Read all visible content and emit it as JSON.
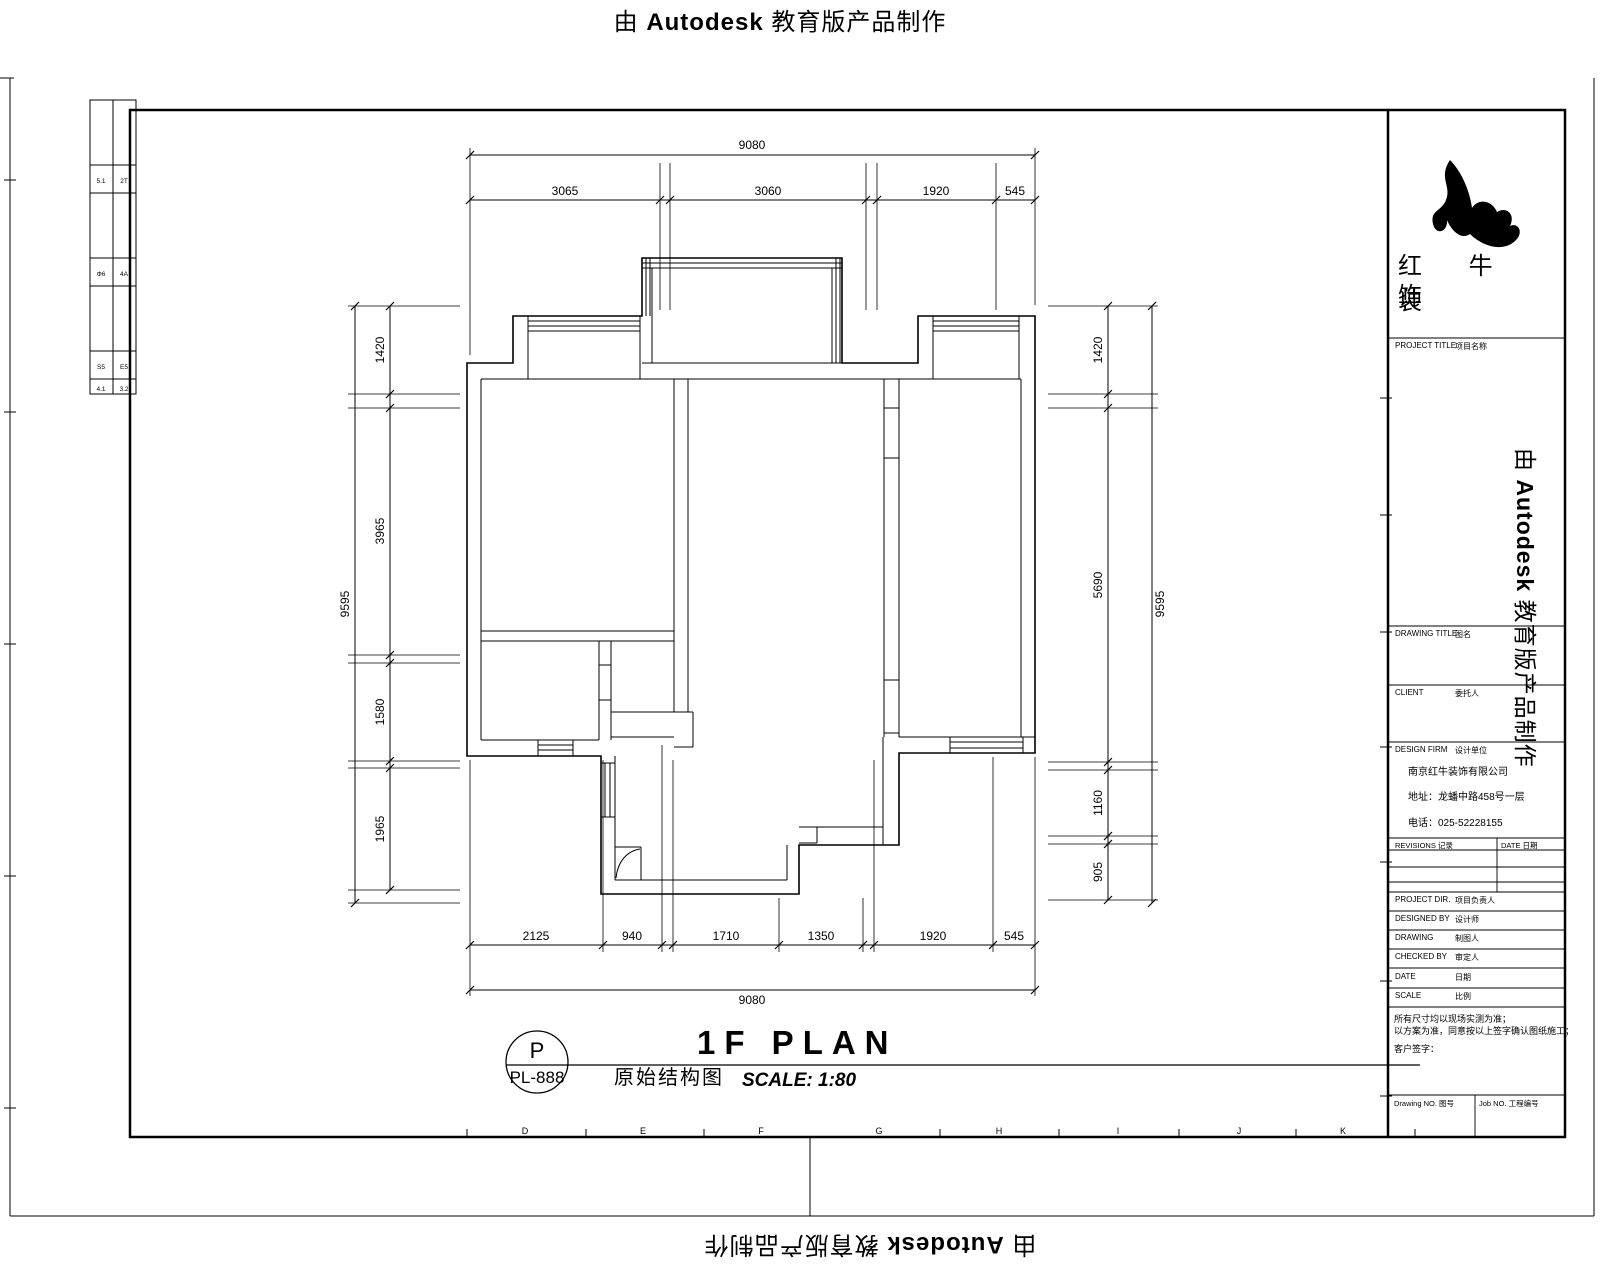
{
  "watermark": {
    "prefix": "由 ",
    "brand": "Autodesk",
    "suffix": " 教育版产品制作"
  },
  "legend_table": {
    "rows": [
      [
        "5.1",
        "2T"
      ],
      [
        "Φ6",
        "4A"
      ],
      [
        "S5",
        "E5"
      ],
      [
        "4.1",
        "3.2"
      ]
    ]
  },
  "grid_letters": [
    "D",
    "E",
    "F",
    "G",
    "H",
    "I",
    "J",
    "K"
  ],
  "dims": {
    "top": {
      "overall": "9080",
      "segments": [
        "3065",
        "3060",
        "1920",
        "545"
      ]
    },
    "bottom": {
      "overall": "9080",
      "segments": [
        "2125",
        "940",
        "1710",
        "1350",
        "1920",
        "545"
      ]
    },
    "left": {
      "overall": "9595",
      "segments": [
        "1420",
        "3965",
        "1580",
        "1965"
      ]
    },
    "right": {
      "overall": "9595",
      "segments": [
        "1420",
        "5690",
        "1160",
        "905"
      ]
    }
  },
  "title": {
    "callout_top": "P",
    "callout_bottom": "PL-888",
    "name_cn": "原始结构图",
    "name_en": "1F PLAN",
    "scale": "SCALE:  1:80"
  },
  "title_block": {
    "company_line1": "红 牛 装",
    "company_line2": "饰",
    "project_title_en": "PROJECT TITLE",
    "project_title_cn": "项目名称",
    "drawing_title_en": "DRAWING TITLE",
    "drawing_title_cn": "图名",
    "client_en": "CLIENT",
    "client_cn": "委托人",
    "design_firm_en": "DESIGN FIRM",
    "design_firm_cn": "设计单位",
    "firm_name": "南京红牛装饰有限公司",
    "firm_address": "地址：龙蟠中路458号一层",
    "firm_phone": "电话：025-52228155",
    "revisions_label": "REVISIONS  记录",
    "rev_date_label": "DATE  日期",
    "project_dir_en": "PROJECT DIR.",
    "project_dir_cn": "项目负责人",
    "designed_by_en": "DESIGNED BY",
    "designed_by_cn": "设计师",
    "drawn_by_en": "DRAWING",
    "drawn_by_cn": "制图人",
    "checked_by_en": "CHECKED BY",
    "checked_by_cn": "审定人",
    "date_en": "DATE",
    "date_cn": "日期",
    "scale_en": "SCALE",
    "scale_cn": "比例",
    "note_line1": "所有尺寸均以现场实测为准；",
    "note_line2": "以方案为准，同意按以上签字确认图纸施工；",
    "note_line3": "客户签字：",
    "drawing_no_label": "Drawing NO.  图号",
    "job_no_label": "Job NO.  工程编号"
  }
}
